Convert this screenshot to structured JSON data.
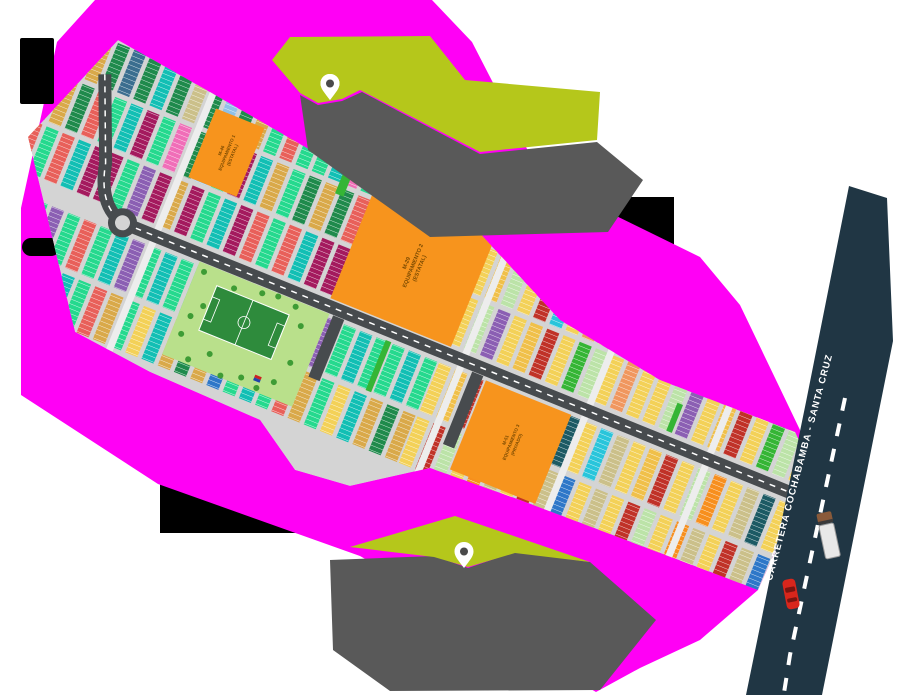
{
  "map": {
    "type": "urbanization-lot-plan",
    "road": {
      "label": "CARRETERA COCHABAMBA - SANTA CRUZ"
    },
    "markers": [
      {
        "name": "north-green-area-pin",
        "style": "white-pin-dark-hole"
      },
      {
        "name": "south-green-area-pin",
        "style": "white-pin-dark-hole"
      }
    ],
    "colors": {
      "background": "#FFFFFF",
      "magenta": "#FF00F5",
      "black_block": "#000000",
      "lime_green_area": "#B5C71B",
      "gray_area": "#595959",
      "highway": "#203644",
      "highway_dash": "#FFFFFF",
      "plan_street": "#D4D4D4",
      "avenue_dark": "#474B4E",
      "park_green": "#B9E08B",
      "field_green": "#2E8B3C",
      "tree_green": "#3E9C35",
      "equip_orange": "#F7941D",
      "pin_fill": "#FFFFFF",
      "pin_hole": "#4A4A4A",
      "car_red": "#D8261C",
      "truck_body": "#E8E8E8",
      "truck_cab": "#8A5A3A"
    }
  },
  "plan": {
    "strip_w": 13,
    "gap": 4.5,
    "blocks": [
      {
        "name": "equipamiento-1",
        "lines": [
          "M-46",
          "EQUIPAMIENTO 1",
          "(ESTATAL)"
        ]
      },
      {
        "name": "equipamiento-2",
        "lines": [
          "M-29",
          "EQUIPAMIENTO 2",
          "(ESTATAL)"
        ]
      },
      {
        "name": "equipamiento-3",
        "lines": [
          "M-51",
          "EQUIPAMIENTO 3",
          "(PRIVADO)"
        ]
      }
    ],
    "rows": [
      {
        "y": -80,
        "h": 46,
        "x0": -60,
        "x1": 410,
        "colors": [
          "#1F8A4C",
          "#1F8A4C",
          "#D9A94A",
          "#1F8A4C",
          "#3B6E8F",
          "#1F8A4C",
          "#12BFB4",
          "#1F8A4C",
          "#CBC08A",
          "#1F8A4C",
          "#8FC1E8",
          "#1F8A4C",
          "#D9A94A",
          "#25D98E",
          "#E8605A",
          "#25D98E",
          "#25D98E",
          "#12BFB4",
          "#F06EB8",
          "#25D98E"
        ]
      },
      {
        "y": -80,
        "h": 46,
        "x0": 410,
        "x1": 800,
        "colors": [
          "#F3D158",
          "#BCE3A8",
          "#F3D158",
          "#D9A94A",
          "#C03228",
          "#F3D158",
          "#BCE3A8",
          "#F0C04A"
        ]
      },
      {
        "y": -29,
        "h": 48,
        "x0": -60,
        "x1": 410,
        "colors": [
          "#1F8A4C",
          "#D9A94A",
          "#1F8A4C",
          "#E8605A",
          "#25D98E",
          "#12BFB4",
          "#A41A5E",
          "#25D98E",
          "#F06EB8",
          "#1F8A4C",
          "#8FC1E8",
          "#25D98E",
          "#A41A5E",
          "#12BFB4",
          "#D9A94A",
          "#25D98E"
        ]
      },
      {
        "y": -29,
        "h": 48,
        "x0": 410,
        "x1": 800,
        "colors": [
          "#F3D158",
          "#F0C04A",
          "#BCE3A8",
          "#F3D158",
          "#C03228",
          "#29C5DB",
          "#F3D158",
          "#F0975F",
          "#F3D158",
          "#BCE3A8"
        ]
      },
      {
        "y": 24,
        "h": 50,
        "x0": -60,
        "x1": 410,
        "colors": [
          "#E8605A",
          "#25D98E",
          "#E8605A",
          "#12BFB4",
          "#A41A5E",
          "#A41A5E",
          "#25D98E",
          "#8B5FB3",
          "#A41A5E",
          "#D9A94A",
          "#A41A5E",
          "#25D98E",
          "#12BFB4",
          "#A41A5E"
        ]
      },
      {
        "y": 24,
        "h": 50,
        "x0": 410,
        "x1": 800,
        "colors": [
          "#F3D158",
          "#BCE3A8",
          "#8B5FB3",
          "#F3D158",
          "#F0C04A",
          "#C03228",
          "#F3D158",
          "#35B535",
          "#BCE3A8",
          "#F3D158",
          "#F0975F",
          "#F3D158"
        ]
      },
      {
        "y": 96,
        "h": 52,
        "x0": -60,
        "x1": 410,
        "colors": [
          "#25D98E",
          "#12BFB4",
          "#25D98E",
          "#8B5FB3",
          "#25D98E",
          "#E8605A",
          "#25D98E",
          "#12BFB4",
          "#8B5FB3",
          "#25D98E",
          "#12BFB4",
          "#25D98E"
        ]
      },
      {
        "y": 96,
        "h": 52,
        "x0": 410,
        "x1": 800,
        "colors": [
          "#F3D158",
          "#F0C04A",
          "#C03228",
          "#F3D158",
          "#BCE3A8",
          "#F78F1E",
          "#F3D158",
          "#CBC08A",
          "#1C5A64",
          "#F3D158",
          "#29C5DB",
          "#CBC08A"
        ]
      },
      {
        "y": 154,
        "h": 50,
        "x0": -60,
        "x1": 410,
        "colors": [
          "#D9A94A",
          "#1F8A4C",
          "#D9A94A",
          "#2E77C8",
          "#25D98E",
          "#12BFB4",
          "#25D98E",
          "#E8605A",
          "#D9A94A",
          "#25D98E",
          "#F3D158",
          "#12BFB4"
        ]
      },
      {
        "y": 154,
        "h": 50,
        "x0": 410,
        "x1": 800,
        "colors": [
          "#F3D158",
          "#C03228",
          "#BCE3A8",
          "#F3D158",
          "#F78F1E",
          "#CBC08A",
          "#F3D158",
          "#C03228",
          "#CBC08A",
          "#2E77C8",
          "#F3D158",
          "#CBC08A"
        ]
      }
    ],
    "trees": [
      [
        158,
        100
      ],
      [
        170,
        132
      ],
      [
        160,
        166
      ],
      [
        176,
        187
      ],
      [
        192,
        104
      ],
      [
        194,
        174
      ],
      [
        212,
        190
      ],
      [
        232,
        184
      ],
      [
        250,
        188
      ],
      [
        264,
        176
      ],
      [
        272,
        152
      ],
      [
        268,
        114
      ],
      [
        256,
        98
      ],
      [
        236,
        95
      ],
      [
        220,
        98
      ],
      [
        162,
        146
      ]
    ]
  }
}
